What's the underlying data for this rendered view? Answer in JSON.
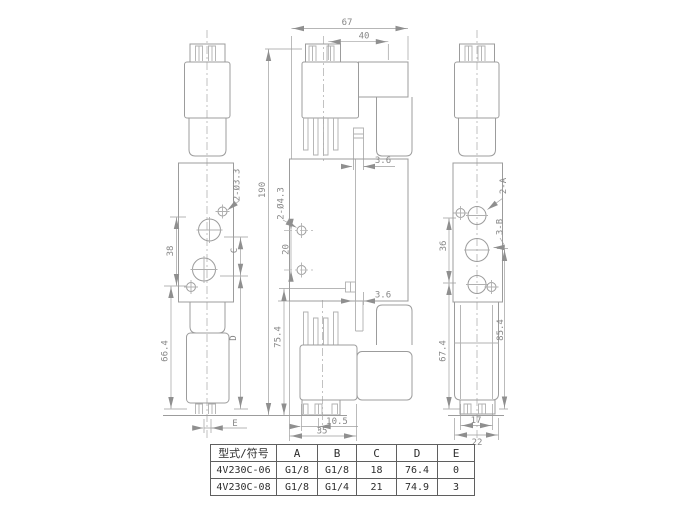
{
  "drawing": {
    "dims": {
      "w67": "67",
      "w40": "40",
      "h190": "190",
      "h20": "20",
      "holes_front": "2-Ø4.3",
      "holes_side": "2-Ø3.3",
      "gap_top": "3.6",
      "gap_bottom": "3.6",
      "h75_4": "75.4",
      "w10_5": "10.5",
      "w35": "35",
      "h38": "38",
      "c_label": "C",
      "h66_4": "66.4",
      "d_label": "D",
      "e_label": "E",
      "ports_a": "2-A",
      "ports_b": "3-B",
      "h36": "36",
      "h67_4": "67.4",
      "h85_4": "85.4",
      "w17": "17",
      "w22": "22"
    },
    "table": {
      "headers": [
        "型式/符号",
        "A",
        "B",
        "C",
        "D",
        "E"
      ],
      "rows": [
        [
          "4V230C-06",
          "G1/8",
          "G1/8",
          "18",
          "76.4",
          "0"
        ],
        [
          "4V230C-08",
          "G1/8",
          "G1/4",
          "21",
          "74.9",
          "3"
        ]
      ]
    }
  }
}
